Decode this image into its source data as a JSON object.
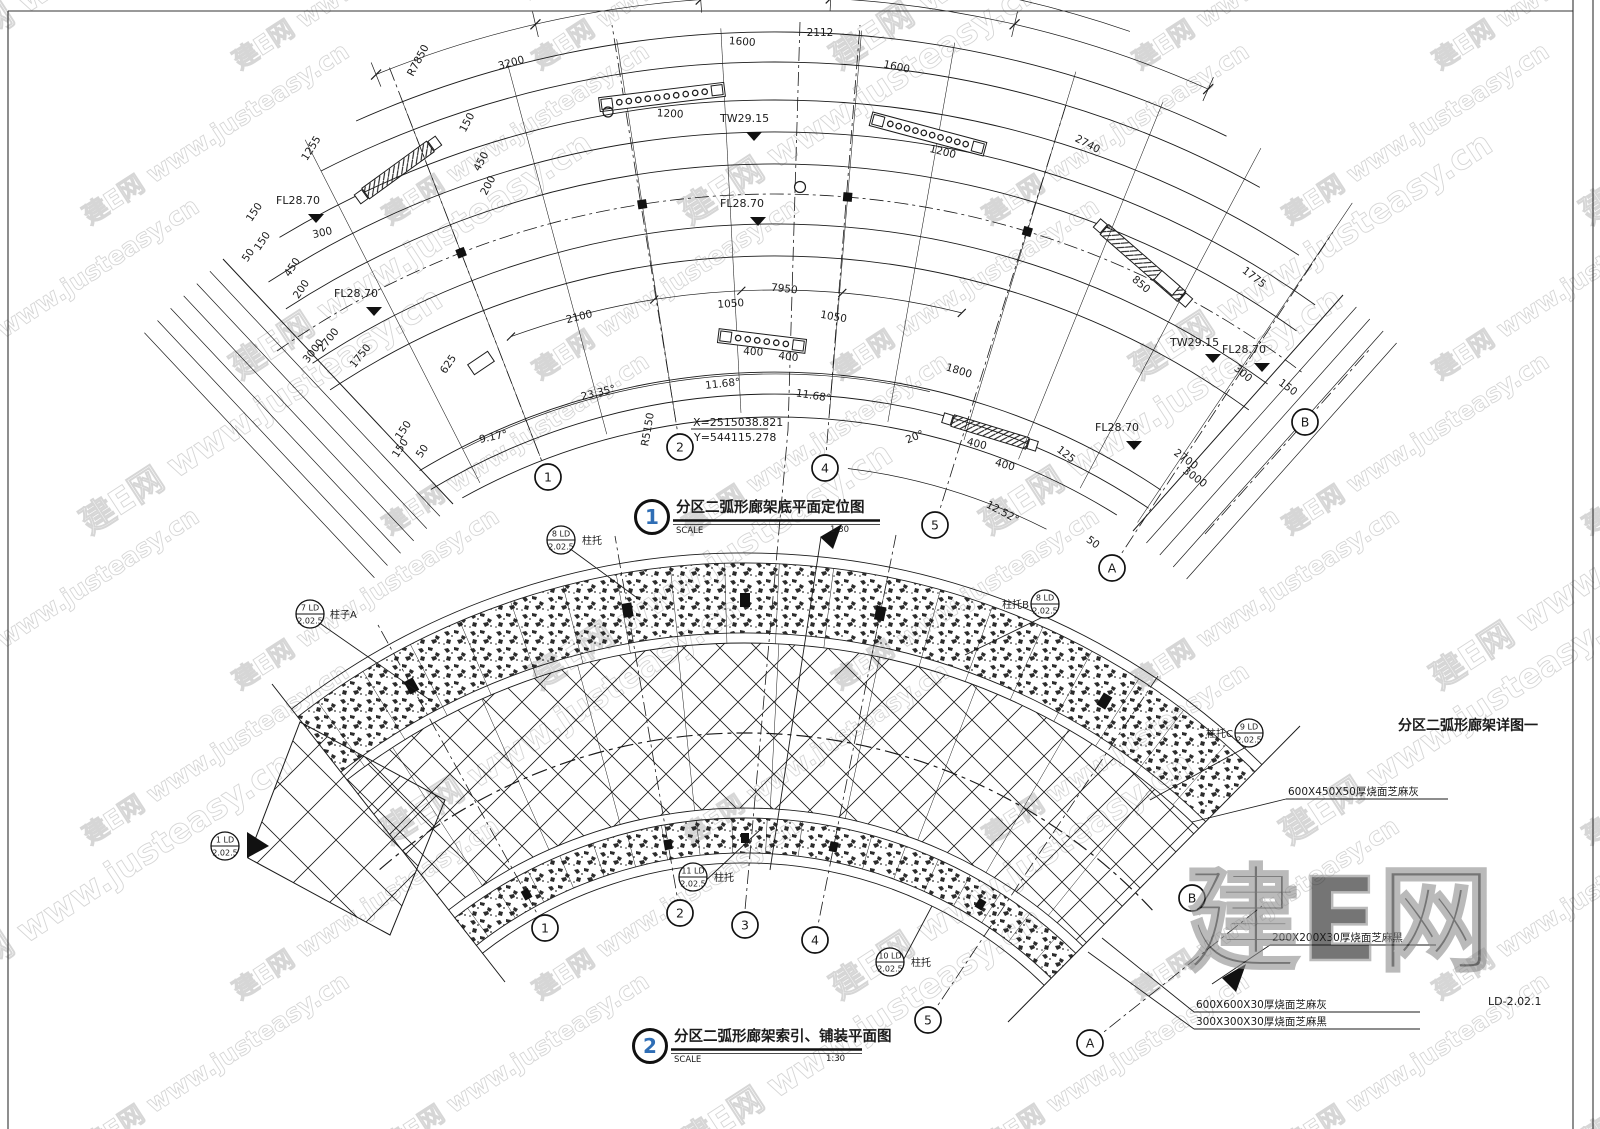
{
  "watermark": {
    "tile": "建E网 www.justeasy.cn",
    "logo": "建E网"
  },
  "sheet": {
    "right_title": "分区二弧形廊架详图一",
    "number": "LD-2.02.1"
  },
  "d1": {
    "num": "1",
    "title": "分区二弧形廊架底平面定位图",
    "scale_label": "SCALE",
    "scale": "1:30",
    "tw": "TW29.15",
    "fl": "FL28.70",
    "coord_x": "X=2515038.821",
    "coord_y": "Y=544115.278",
    "dims": [
      "3200",
      "1600",
      "2112",
      "1600",
      "2740",
      "1775",
      "1200",
      "1200",
      "1255",
      "150",
      "450",
      "200",
      "150",
      "300",
      "150",
      "50",
      "450",
      "200",
      "2700",
      "1750",
      "3000",
      "625",
      "2100",
      "1050",
      "7950",
      "1050",
      "400",
      "400",
      "150",
      "150",
      "50",
      "1800",
      "400",
      "400",
      "125",
      "850",
      "300",
      "2700",
      "3000",
      "150",
      "50",
      "R7850",
      "R5150"
    ],
    "angles": [
      "9.17°",
      "23.35°",
      "11.68°",
      "11.68°",
      "20°",
      "12.52°"
    ],
    "grid": [
      "1",
      "2",
      "4",
      "5",
      "A",
      "B"
    ]
  },
  "d2": {
    "num": "2",
    "title": "分区二弧形廊架索引、铺装平面图",
    "scale_label": "SCALE",
    "scale": "1:30",
    "balloons": [
      {
        "top": "8 LD",
        "bot": "2.02.5",
        "label": "柱托"
      },
      {
        "top": "7 LD",
        "bot": "2.02.5",
        "label": "柱子A"
      },
      {
        "top": "8 LD",
        "bot": "2.02.5",
        "label": "柱托B"
      },
      {
        "top": "9 LD",
        "bot": "2.02.5",
        "label": "柱托C"
      },
      {
        "top": "11 LD",
        "bot": "2.02.5",
        "label": "柱托"
      },
      {
        "top": "10 LD",
        "bot": "2.02.5",
        "label": "柱托"
      },
      {
        "top": "1 LD",
        "bot": "2.02.5",
        "label": ""
      }
    ],
    "callouts": [
      "600X450X50厚烧面芝麻灰",
      "200X200X30厚烧面芝麻黑",
      "600X600X30厚烧面芝麻灰",
      "300X300X30厚烧面芝麻黑"
    ],
    "grid": [
      "1",
      "2",
      "3",
      "4",
      "5",
      "A",
      "B"
    ]
  }
}
